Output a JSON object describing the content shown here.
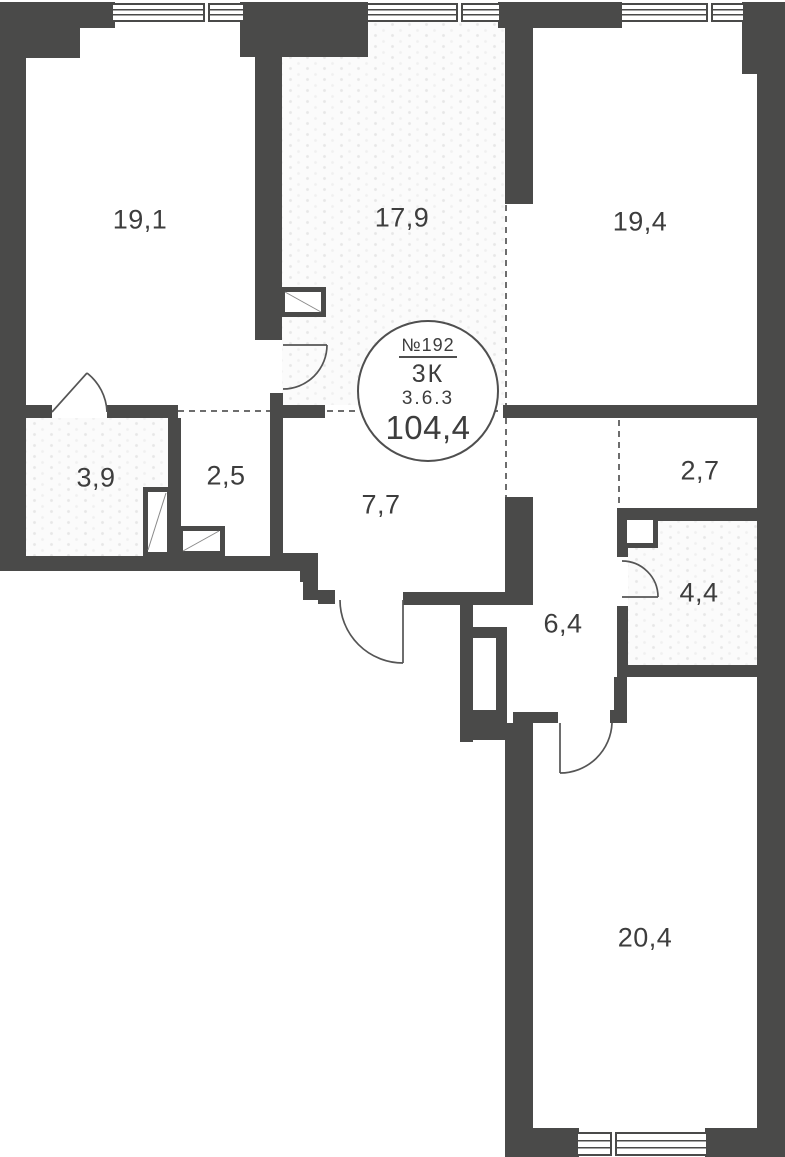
{
  "badge": {
    "number": "№192",
    "type": "3К",
    "code": "3.6.3",
    "total_area": "104,4"
  },
  "rooms": [
    {
      "id": "room-top-left",
      "area": "19,1"
    },
    {
      "id": "room-kitchen-living",
      "area": "17,9"
    },
    {
      "id": "room-top-right",
      "area": "19,4"
    },
    {
      "id": "room-bath-small",
      "area": "3,9"
    },
    {
      "id": "room-wardrobe-left",
      "area": "2,5"
    },
    {
      "id": "room-corridor",
      "area": "7,7"
    },
    {
      "id": "room-wardrobe-right",
      "area": "2,7"
    },
    {
      "id": "room-bath-right",
      "area": "4,4"
    },
    {
      "id": "room-hall",
      "area": "6,4"
    },
    {
      "id": "room-bottom",
      "area": "20,4"
    }
  ]
}
